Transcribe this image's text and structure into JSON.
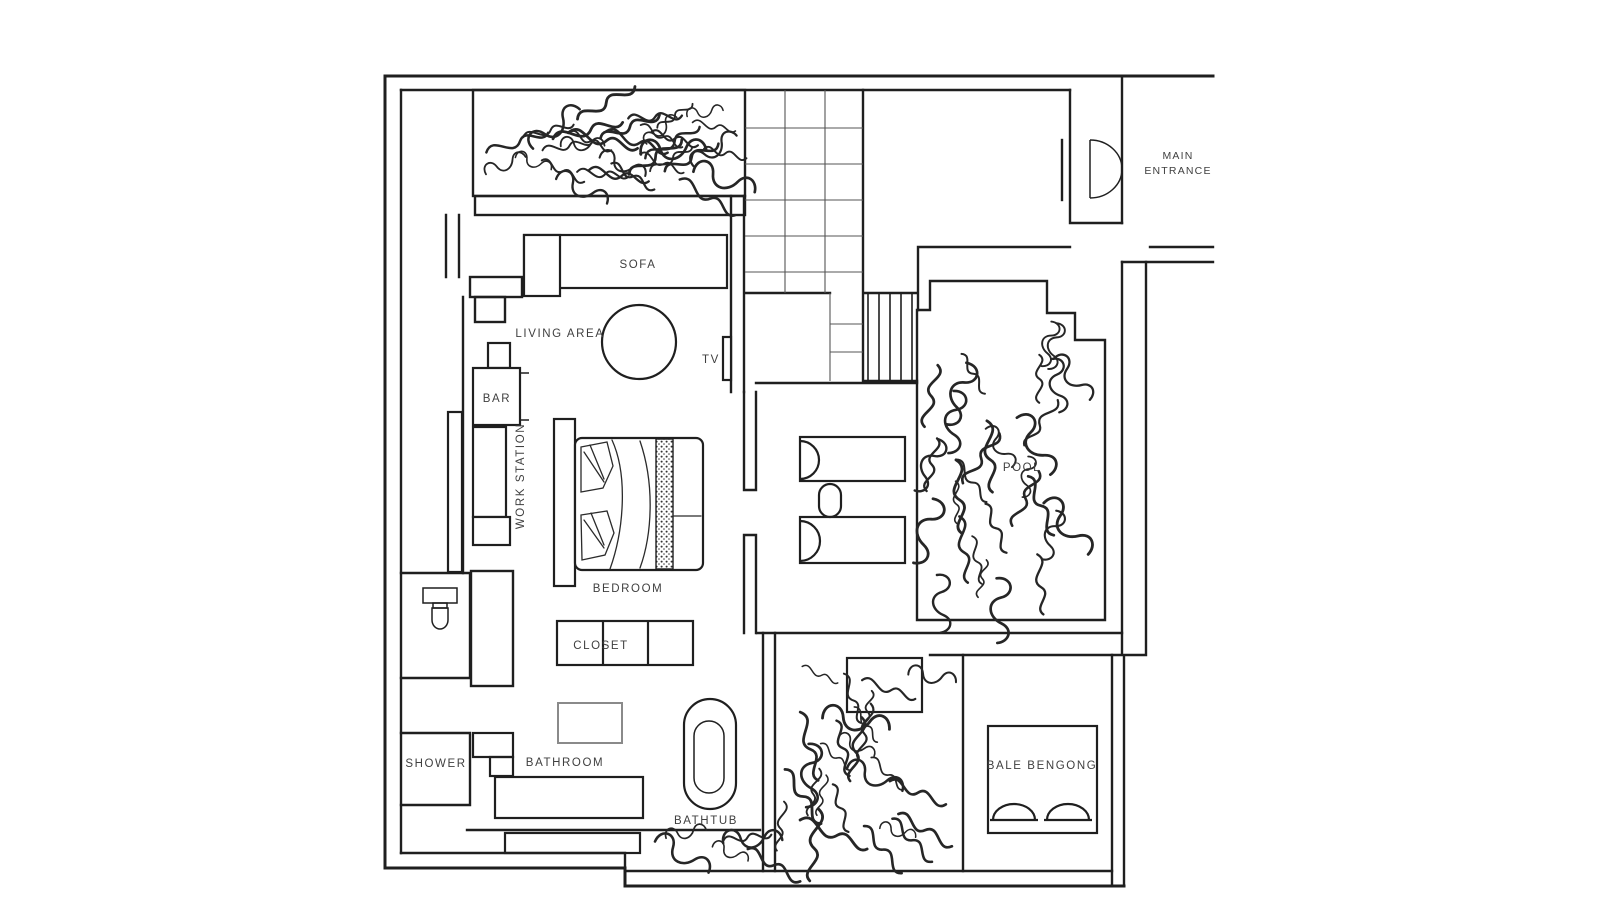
{
  "page": {
    "background": "#ffffff"
  },
  "colors": {
    "line": "#1f1f1f",
    "text": "#3f3f3f",
    "grid": "#555555"
  },
  "labels": {
    "sofa": "SOFA",
    "living_area": "LIVING AREA",
    "tv": "TV",
    "bar": "BAR",
    "work_station": "WORK STATION",
    "bedroom": "BEDROOM",
    "closet": "CLOSET",
    "shower": "SHOWER",
    "bathroom": "BATHROOM",
    "bathtub": "BATHTUB",
    "pool": "POOL",
    "bale_bengong": "BALE BENGONG",
    "main_entrance_line1": "MAIN",
    "main_entrance_line2": "ENTRANCE"
  }
}
